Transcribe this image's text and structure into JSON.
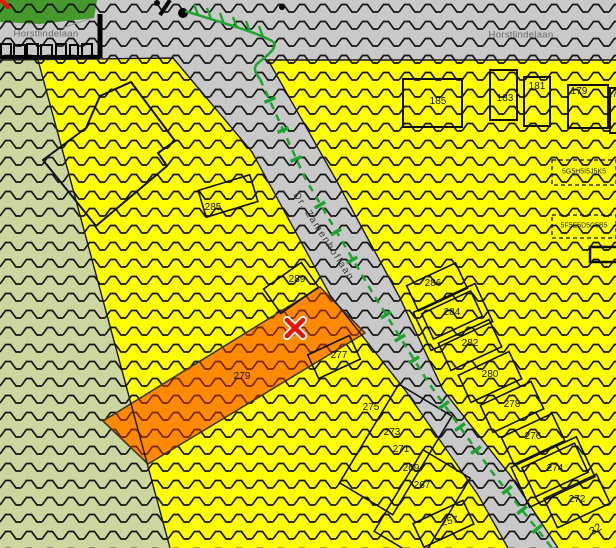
{
  "streets": {
    "top_left": "Horstlindelaan",
    "top_right": "Horstlindelaan",
    "diagonal": "Dr. Zamenhoflaan"
  },
  "parcels": {
    "items": [
      {
        "label": "285"
      },
      {
        "label": "289"
      },
      {
        "label": "279"
      },
      {
        "label": "277"
      },
      {
        "label": "275"
      },
      {
        "label": "273"
      },
      {
        "label": "271"
      },
      {
        "label": "269"
      },
      {
        "label": "267"
      },
      {
        "label": "257"
      },
      {
        "label": "185"
      },
      {
        "label": "183"
      },
      {
        "label": "181"
      },
      {
        "label": "179"
      },
      {
        "label": "17"
      },
      {
        "label": "286"
      },
      {
        "label": "284"
      },
      {
        "label": "282"
      },
      {
        "label": "280"
      },
      {
        "label": "278"
      },
      {
        "label": "276"
      },
      {
        "label": "274"
      },
      {
        "label": "272"
      },
      {
        "label": "32"
      }
    ]
  },
  "annotations": {
    "row1": "5G5H5I5J5K5",
    "row2": "5F5E5D5C5B5"
  },
  "marker": {
    "symbol": "x",
    "color": "#e81309"
  },
  "colors": {
    "urban_yellow": "#ffff00",
    "road_gray": "#c9c9c9",
    "rural_green": "#ccd7a0",
    "park_green": "#44982c",
    "highlight_orange": "#ff8a00",
    "hatch_black": "#161616",
    "hatch_dark_red": "#7c2600",
    "boundary_green": "#1ea32e"
  }
}
